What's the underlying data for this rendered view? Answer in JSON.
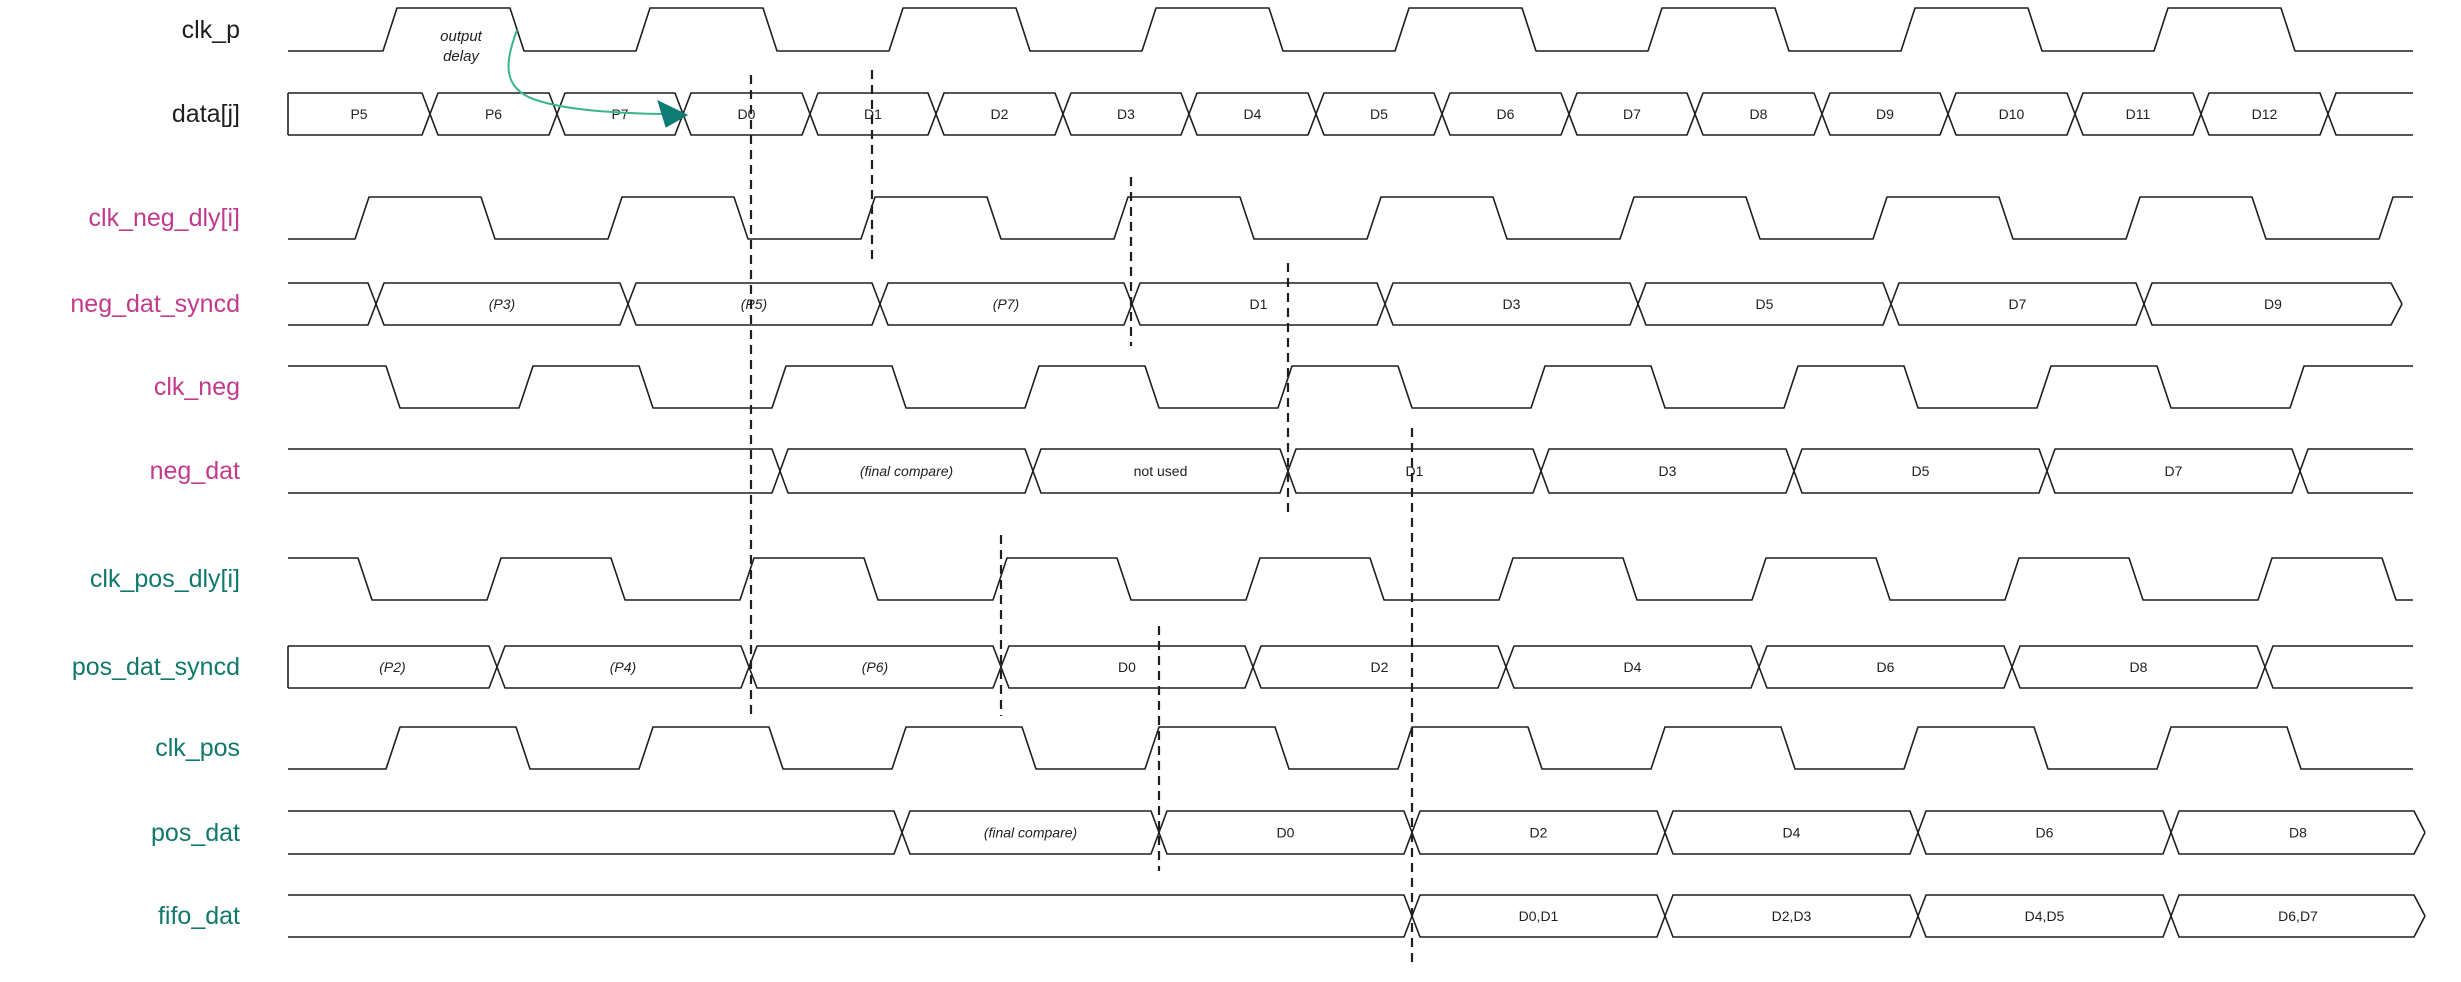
{
  "diagram": {
    "width": 2461,
    "height": 982,
    "wave_start_x": 288,
    "wave_end_x": 2413,
    "line_color": "#1f1f1f",
    "annotation": {
      "line1": "output",
      "line2": "delay",
      "x": 461,
      "y1": 41,
      "y2": 61
    },
    "arrow": {
      "line_color": "#3bb687",
      "head_color": "#0e7c74",
      "path": "M 517,30 C 506,60 500,88 536,100 C 566,110 612,113 662,114",
      "head_points": "687,115 658,101 666,127"
    },
    "signals": [
      {
        "name": "clk_p",
        "color": "#1f1f1f",
        "type": "clock",
        "y": [
          8,
          51
        ],
        "start_level": "low",
        "edges": [
          383,
          510,
          636,
          763,
          889,
          1016,
          1142,
          1269,
          1395,
          1522,
          1648,
          1775,
          1901,
          2028,
          2154,
          2281
        ]
      },
      {
        "name": "data[j]",
        "color": "#1f1f1f",
        "type": "bus",
        "y": [
          93,
          135
        ],
        "start": "closed",
        "end": "open",
        "cells": [
          {
            "x1": 288,
            "x2": 430,
            "label": "P5"
          },
          {
            "x1": 430,
            "x2": 557,
            "label": "P6"
          },
          {
            "x1": 557,
            "x2": 683,
            "label": "P7"
          },
          {
            "x1": 683,
            "x2": 810,
            "label": "D0"
          },
          {
            "x1": 810,
            "x2": 936,
            "label": "D1"
          },
          {
            "x1": 936,
            "x2": 1063,
            "label": "D2"
          },
          {
            "x1": 1063,
            "x2": 1189,
            "label": "D3"
          },
          {
            "x1": 1189,
            "x2": 1316,
            "label": "D4"
          },
          {
            "x1": 1316,
            "x2": 1442,
            "label": "D5"
          },
          {
            "x1": 1442,
            "x2": 1569,
            "label": "D6"
          },
          {
            "x1": 1569,
            "x2": 1695,
            "label": "D7"
          },
          {
            "x1": 1695,
            "x2": 1822,
            "label": "D8"
          },
          {
            "x1": 1822,
            "x2": 1948,
            "label": "D9"
          },
          {
            "x1": 1948,
            "x2": 2075,
            "label": "D10"
          },
          {
            "x1": 2075,
            "x2": 2201,
            "label": "D11"
          },
          {
            "x1": 2201,
            "x2": 2328,
            "label": "D12"
          },
          {
            "x1": 2328,
            "x2": 2413,
            "label": ""
          }
        ]
      },
      {
        "name": "clk_neg_dly[i]",
        "color": "#c13a8c",
        "type": "clock",
        "y": [
          197,
          239
        ],
        "start_level": "low",
        "edges": [
          355,
          481,
          608,
          734,
          861,
          987,
          1114,
          1240,
          1367,
          1493,
          1620,
          1746,
          1873,
          1999,
          2126,
          2252,
          2379
        ]
      },
      {
        "name": "neg_dat_syncd",
        "color": "#c13a8c",
        "type": "bus",
        "y": [
          283,
          325
        ],
        "start": "open",
        "end": "point",
        "cells": [
          {
            "x1": 288,
            "x2": 376,
            "label": ""
          },
          {
            "x1": 376,
            "x2": 628,
            "label": "(P3)"
          },
          {
            "x1": 628,
            "x2": 880,
            "label": "(P5)"
          },
          {
            "x1": 880,
            "x2": 1132,
            "label": "(P7)"
          },
          {
            "x1": 1132,
            "x2": 1385,
            "label": "D1"
          },
          {
            "x1": 1385,
            "x2": 1638,
            "label": "D3"
          },
          {
            "x1": 1638,
            "x2": 1891,
            "label": "D5"
          },
          {
            "x1": 1891,
            "x2": 2144,
            "label": "D7"
          },
          {
            "x1": 2144,
            "x2": 2402,
            "label": "D9"
          }
        ]
      },
      {
        "name": "clk_neg",
        "color": "#c13a8c",
        "type": "clock",
        "y": [
          366,
          408
        ],
        "start_level": "high",
        "edges": [
          386,
          519,
          639,
          772,
          892,
          1025,
          1145,
          1278,
          1398,
          1531,
          1651,
          1784,
          1904,
          2037,
          2157,
          2290
        ]
      },
      {
        "name": "neg_dat",
        "color": "#c13a8c",
        "type": "bus",
        "y": [
          449,
          493
        ],
        "start": "open",
        "end": "open",
        "cells": [
          {
            "x1": 288,
            "x2": 780,
            "label": ""
          },
          {
            "x1": 780,
            "x2": 1033,
            "label": "(final compare)"
          },
          {
            "x1": 1033,
            "x2": 1288,
            "label": "not used"
          },
          {
            "x1": 1288,
            "x2": 1541,
            "label": "D1"
          },
          {
            "x1": 1541,
            "x2": 1794,
            "label": "D3"
          },
          {
            "x1": 1794,
            "x2": 2047,
            "label": "D5"
          },
          {
            "x1": 2047,
            "x2": 2300,
            "label": "D7"
          },
          {
            "x1": 2300,
            "x2": 2413,
            "label": ""
          }
        ]
      },
      {
        "name": "clk_pos_dly[i]",
        "color": "#11786c",
        "type": "clock",
        "y": [
          558,
          600
        ],
        "start_level": "high",
        "edges": [
          358,
          487,
          611,
          740,
          864,
          993,
          1117,
          1246,
          1370,
          1499,
          1623,
          1752,
          1876,
          2005,
          2129,
          2258,
          2382
        ]
      },
      {
        "name": "pos_dat_syncd",
        "color": "#11786c",
        "type": "bus",
        "y": [
          646,
          688
        ],
        "start": "closed",
        "end": "open",
        "cells": [
          {
            "x1": 288,
            "x2": 497,
            "label": "(P2)"
          },
          {
            "x1": 497,
            "x2": 749,
            "label": "(P4)"
          },
          {
            "x1": 749,
            "x2": 1001,
            "label": "(P6)"
          },
          {
            "x1": 1001,
            "x2": 1253,
            "label": "D0"
          },
          {
            "x1": 1253,
            "x2": 1506,
            "label": "D2"
          },
          {
            "x1": 1506,
            "x2": 1759,
            "label": "D4"
          },
          {
            "x1": 1759,
            "x2": 2012,
            "label": "D6"
          },
          {
            "x1": 2012,
            "x2": 2265,
            "label": "D8"
          },
          {
            "x1": 2265,
            "x2": 2413,
            "label": ""
          }
        ]
      },
      {
        "name": "clk_pos",
        "color": "#11786c",
        "type": "clock",
        "y": [
          727,
          769
        ],
        "start_level": "low",
        "edges": [
          386,
          516,
          639,
          769,
          892,
          1022,
          1145,
          1275,
          1398,
          1528,
          1651,
          1781,
          1904,
          2034,
          2157,
          2287
        ]
      },
      {
        "name": "pos_dat",
        "color": "#11786c",
        "type": "bus",
        "y": [
          811,
          854
        ],
        "start": "open",
        "end": "point",
        "cells": [
          {
            "x1": 288,
            "x2": 902,
            "label": ""
          },
          {
            "x1": 902,
            "x2": 1159,
            "label": "(final compare)"
          },
          {
            "x1": 1159,
            "x2": 1412,
            "label": "D0"
          },
          {
            "x1": 1412,
            "x2": 1665,
            "label": "D2"
          },
          {
            "x1": 1665,
            "x2": 1918,
            "label": "D4"
          },
          {
            "x1": 1918,
            "x2": 2171,
            "label": "D6"
          },
          {
            "x1": 2171,
            "x2": 2425,
            "label": "D8"
          }
        ]
      },
      {
        "name": "fifo_dat",
        "color": "#11786c",
        "type": "bus",
        "y": [
          895,
          937
        ],
        "start": "open",
        "end": "point",
        "cells": [
          {
            "x1": 288,
            "x2": 1412,
            "label": ""
          },
          {
            "x1": 1412,
            "x2": 1665,
            "label": "D0,D1"
          },
          {
            "x1": 1665,
            "x2": 1918,
            "label": "D2,D3"
          },
          {
            "x1": 1918,
            "x2": 2171,
            "label": "D4,D5"
          },
          {
            "x1": 2171,
            "x2": 2425,
            "label": "D6,D7"
          }
        ]
      }
    ],
    "dashed_markers": [
      {
        "x": 751,
        "y1": 75,
        "y2": 716
      },
      {
        "x": 872,
        "y1": 70,
        "y2": 262
      },
      {
        "x": 1131,
        "y1": 177,
        "y2": 346
      },
      {
        "x": 1288,
        "y1": 263,
        "y2": 513
      },
      {
        "x": 1001,
        "y1": 535,
        "y2": 716
      },
      {
        "x": 1159,
        "y1": 626,
        "y2": 871
      },
      {
        "x": 1412,
        "y1": 428,
        "y2": 965
      }
    ]
  }
}
